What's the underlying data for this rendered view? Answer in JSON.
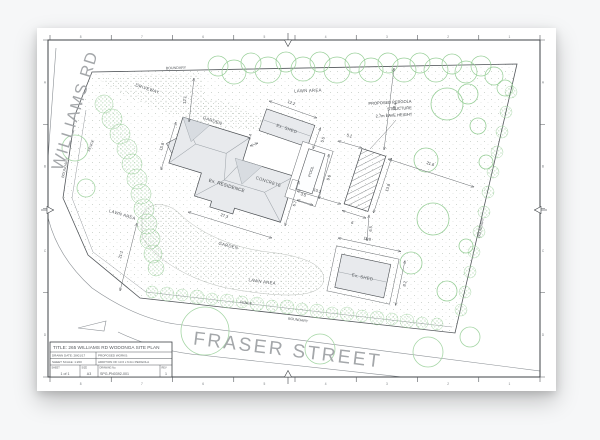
{
  "colors": {
    "paper": "#ffffff",
    "line": "#4a4e52",
    "tree_green": "#8fc98f",
    "street_text": "#a4a7aa",
    "building_fill": "#e8eaed"
  },
  "streets": {
    "williams_rd": "WILLIAMS RD",
    "fraser_street": "FRASER STREET"
  },
  "site": {
    "boundary": "BOUNDARY",
    "fence": "FENCE",
    "driveway": "DRIVEWAY",
    "garden": "GARDEN",
    "lawn_area": "LAWN AREA",
    "concrete": "CONCRETE"
  },
  "buildings": {
    "residence": "Ex. RESIDENCE",
    "shed": "Ex. SHED",
    "pool": "POOL"
  },
  "pergola_note": {
    "line1": "PROPOSED PERGOLA",
    "line2": "STRUCTURE",
    "line3": "2.7m EAVE HEIGHT"
  },
  "dimensions": {
    "shed1_length": "12.2",
    "shed1_gap": "2.4",
    "shed1_width": "5.5",
    "house_left": "15.8",
    "house_bottom": "27.3",
    "house_right": "6.7",
    "house_to_pergola": "10.2",
    "pool_width": "3.5",
    "pool_length": "9.6",
    "pergola_gap": "5.1",
    "pergola_length": "13.8",
    "pergola_width": "6",
    "pergola_to_boundary": "21.6",
    "pergola_to_north_boundary": "19.4",
    "driveway_depth": "12.1",
    "lawn_depth": "21.1",
    "pergola_to_shed": "6.5",
    "shed2_length": "11.8",
    "shed2_width": "8.2"
  },
  "frame": {
    "grid_numbers": [
      "8",
      "7",
      "6",
      "5",
      "4",
      "3",
      "2",
      "1"
    ],
    "grid_letters": [
      "A",
      "B",
      "C",
      "D"
    ]
  },
  "title_block": {
    "title": "TITLE: 265 WILLIAMS RD WODONGA SITE PLAN",
    "drawn_date": "DRAWN DATE: 28/01/17",
    "proposed_works": "PROPOSED WORKS:",
    "scale": "SHEET SCALE: 1:200",
    "works_description": "ADDITION OF 13.6 x 6.0m PERGOLA",
    "sheet_label": "SHEET",
    "sheet_value": "1 of 1",
    "size_label": "SIZE",
    "size_value": "A3",
    "drawing_no_label": "DRAWING No.",
    "drawing_no_value": "SPG-PN0392-001",
    "rev_label": "REV",
    "rev_value": "1"
  }
}
